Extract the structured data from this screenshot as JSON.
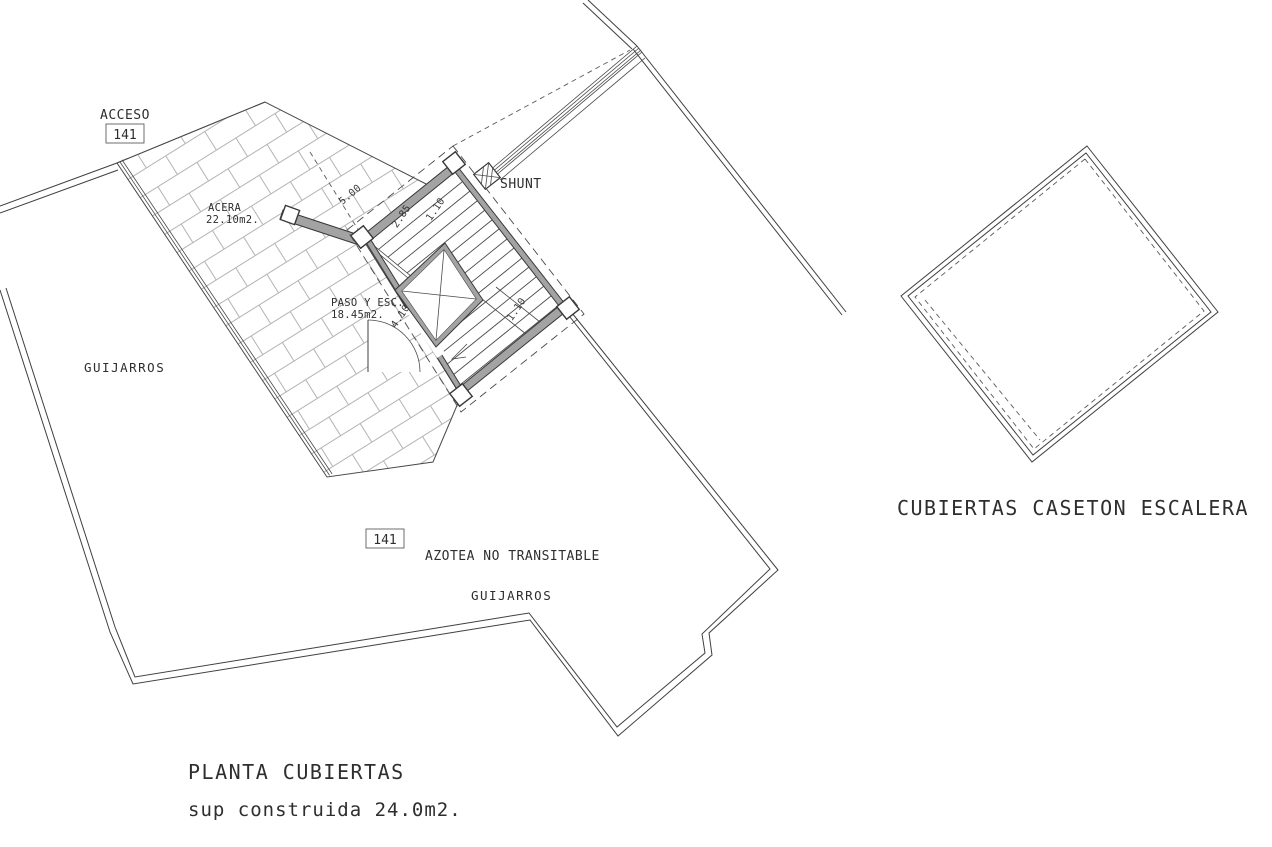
{
  "drawing": {
    "title": "PLANTA CUBIERTAS",
    "subtitle": "sup construida 24.0m2.",
    "secondary_figure_label": "CUBIERTAS CASETON ESCALERA",
    "labels": {
      "acceso": "ACCESO",
      "acceso_ref": "141",
      "acera_name": "ACERA",
      "acera_area": "22.10m2.",
      "guijarros_left": "GUIJARROS",
      "paso_name": "PASO Y ESC.",
      "paso_area": "18.45m2.",
      "shunt": "SHUNT",
      "azotea_ref": "141",
      "azotea": "AZOTEA NO TRANSITABLE",
      "guijarros_center": "GUIJARROS"
    },
    "dimensions": [
      "5.00",
      "2.85",
      "1.10",
      "4.10",
      "1.10"
    ],
    "colors": {
      "line": "#3a3a3a",
      "wall_fill": "#a3a3a3",
      "hatch_line": "#b3b3b3",
      "background": "#ffffff"
    }
  }
}
